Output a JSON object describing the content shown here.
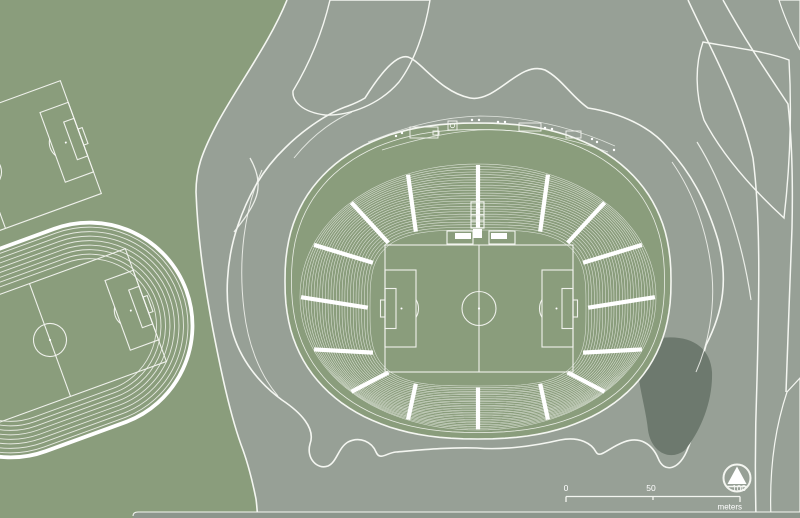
{
  "map": {
    "kind": "stadium-site-plan",
    "features": {
      "stadium_bowl": "stadium seating bowl with central soccer pitch",
      "running_track": "athletics track with soccer field infield",
      "practice_field": "soccer practice field",
      "podium": "stadium podium terrace",
      "plaza": "pedestrian plaza and roads"
    }
  },
  "scale_bar": {
    "ticks": [
      "0",
      "50",
      "100"
    ],
    "unit": "meters"
  },
  "compass": {
    "icon": "compass-north-icon"
  },
  "colors": {
    "c-green": "#8a9d7c",
    "c-plaza": "#97a096",
    "c-podium": "#7b867b",
    "c-podium-dark": "#6d796e",
    "c-strip": "#8c968c",
    "c-line": "#f4f6f1",
    "c-white": "#ffffff"
  }
}
